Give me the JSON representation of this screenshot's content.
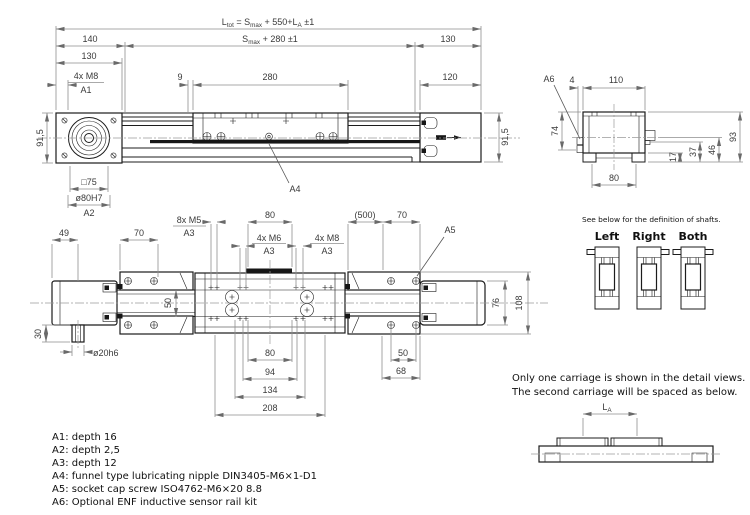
{
  "page": {
    "background": "#ffffff",
    "object_line_color": "#1c1c1c",
    "dimension_line_color": "#8e8e8e",
    "dimension_text_color": "#3a3a3a",
    "note_text_color": "#101010"
  },
  "side_view": {
    "ltot": {
      "p1": "L",
      "s1": "tot",
      "p2": " =  S",
      "s2": "max",
      "p3": " +  550+L",
      "s3": "A",
      "p4": "  ±1"
    },
    "smax": {
      "p1": "S",
      "s1": "max",
      "p2": " +  280  ±1"
    },
    "d140": "140",
    "d130_left": "130",
    "d130_right": "130",
    "d120": "120",
    "m8": "4x  M8",
    "a1": "A1",
    "d9": "9",
    "d280": "280",
    "d915_left": "91,5",
    "d915_right": "91,5",
    "sq75": "□75",
    "d80h7": "ø80H7",
    "a2": "A2",
    "a4": "A4"
  },
  "end_view": {
    "a6": "A6",
    "d4": "4",
    "d110": "110",
    "d74": "74",
    "d93": "93",
    "d46": "46",
    "d37": "37",
    "d17": "17",
    "d80": "80"
  },
  "plan_view": {
    "d49": "49",
    "d70_left": "70",
    "m5": "8x  M5",
    "a3_1": "A3",
    "d80_top": "80",
    "m6": "4x  M6",
    "a3_2": "A3",
    "m8": "4x  M8",
    "a3_3": "A3",
    "d500": "(500)",
    "d70_right": "70",
    "a5": "A5",
    "d50_mid": "50",
    "d30": "30",
    "d20h6": "ø20h6",
    "d80_bot": "80",
    "d94": "94",
    "d134": "134",
    "d208": "208",
    "d50_right": "50",
    "d68": "68",
    "d76": "76",
    "d108": "108"
  },
  "shafts": {
    "note": "See below for the definition of shafts.",
    "left": "Left",
    "right": "Right",
    "both": "Both"
  },
  "carriage_note": {
    "line1": "Only one carriage is shown in the detail views.",
    "line2": "The second carriage will be spaced as below.",
    "la": {
      "p1": "L",
      "s1": "A"
    }
  },
  "notes": {
    "a1": "A1: depth 16",
    "a2": "A2: depth 2,5",
    "a3": "A3: depth 12",
    "a4": "A4: funnel type lubricating nipple DIN3405-M6×1-D1",
    "a5": "A5: socket cap screw ISO4762-M6×20 8.8",
    "a6": "A6: Optional ENF inductive sensor rail kit"
  }
}
